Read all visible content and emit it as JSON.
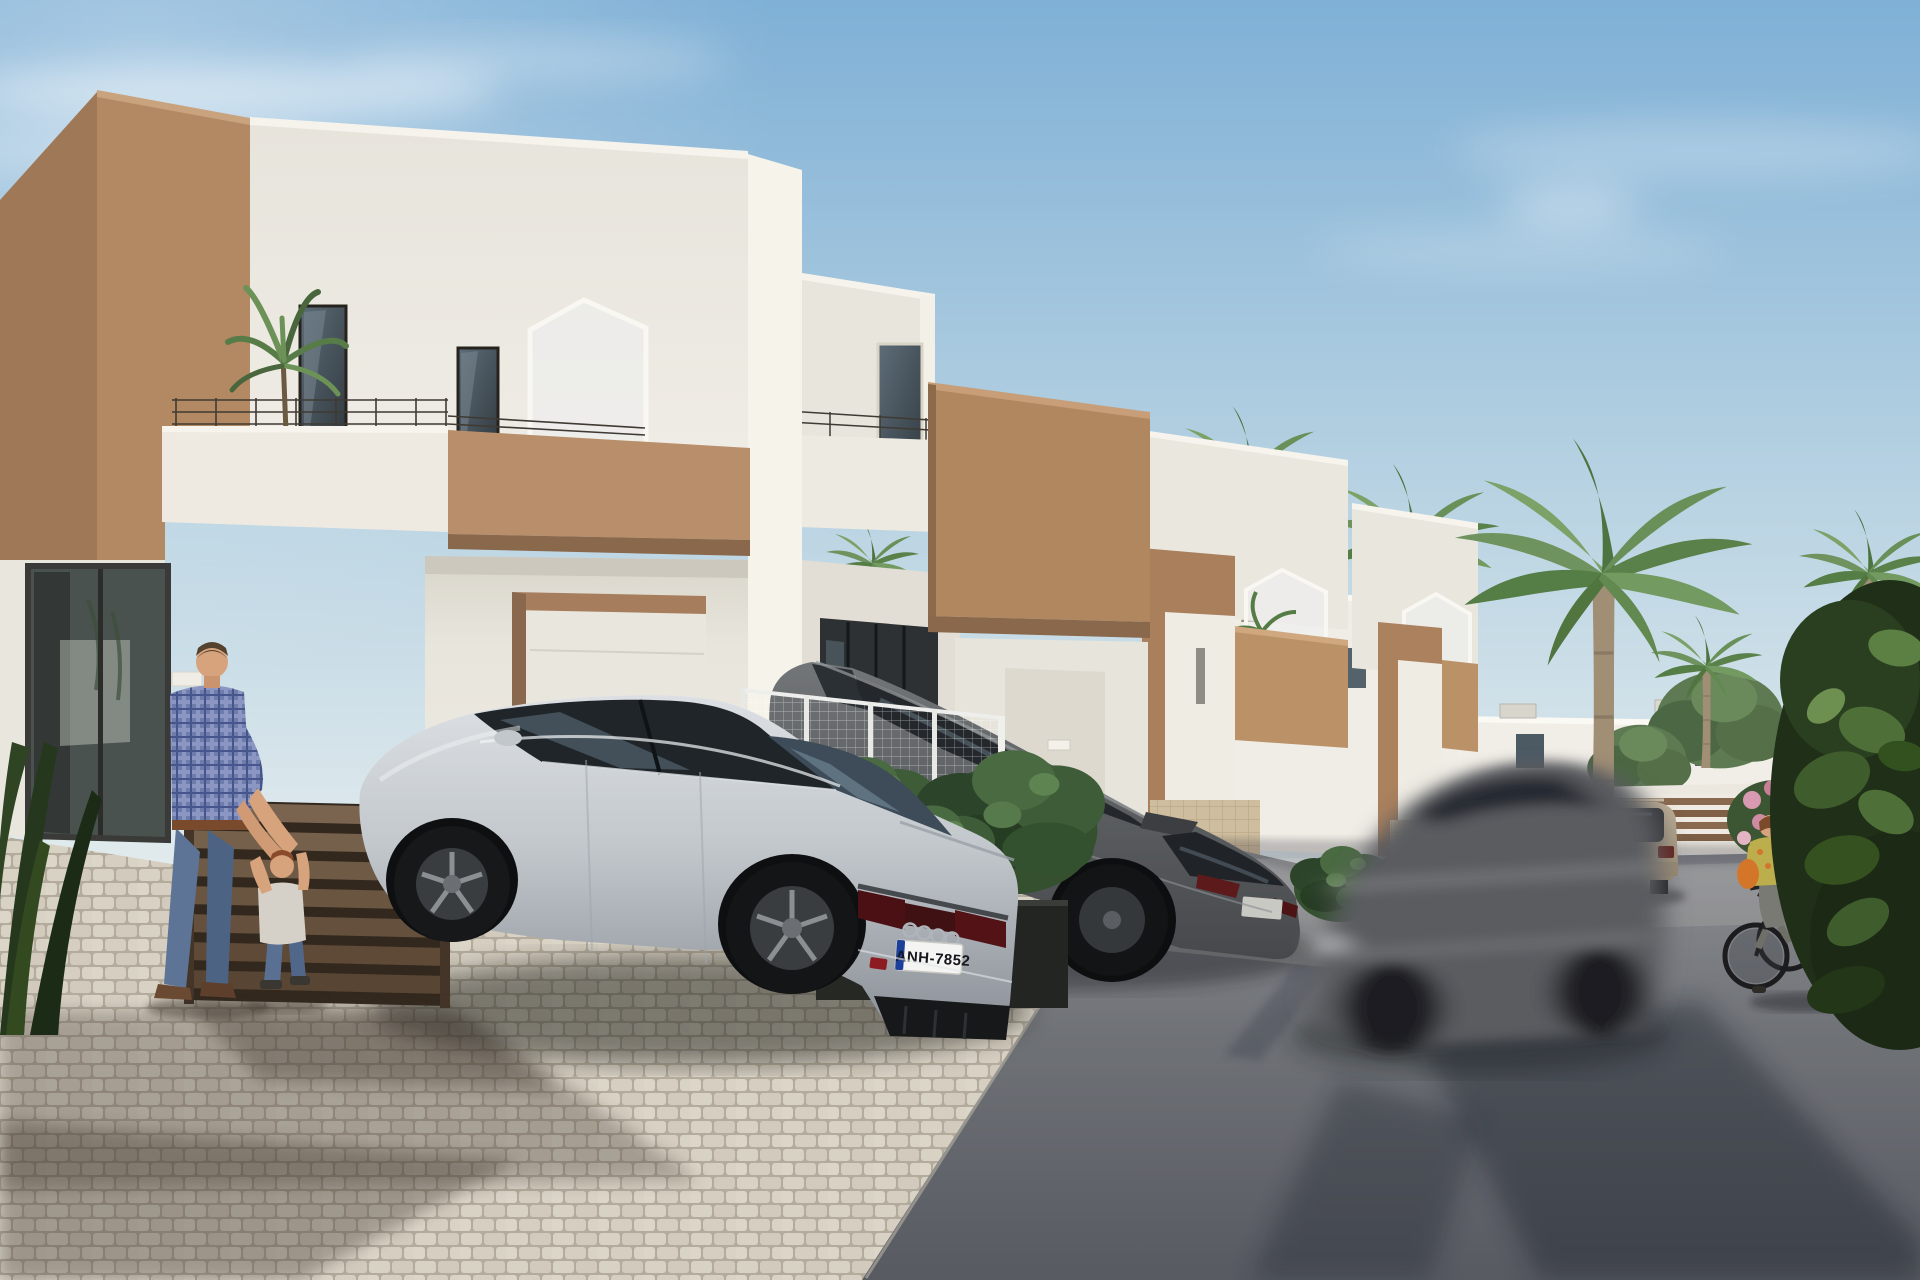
{
  "scene": {
    "type": "3D architectural visualization",
    "title": "New-build townhouse street, sunny day",
    "sky": "clear blue with wispy clouds",
    "lighting": "sun from upper left, shadows cast to lower right"
  },
  "palette": {
    "sky_top": "#7fb0d6",
    "sky_horizon": "#e3ecee",
    "wall_white": "#ece9e1",
    "accent_tan": "#b28a66",
    "paving_cobble": "#d5cec1",
    "asphalt": "#6f7277",
    "foliage_green": "#4e6f41",
    "car_silver": "#c6cbd0",
    "car_graphite": "#5b5e61",
    "car_beige": "#a8977e",
    "plaid_shirt_blue": "#6d7cab",
    "cyclist_top_yellow": "#bcae4c",
    "plate_band_blue": "#1d3f9c",
    "plaque_gold": "#b5922f"
  },
  "buildings": {
    "foreground_houses_count": 4,
    "style": "modern two-storey white townhouses with tan accent volumes",
    "features": [
      "roof terraces with thin dark railings",
      "pentagon frosted-glass privacy screens",
      "tan entrance portals with white reveals",
      "gold house-number plaques",
      "ground-floor glass sliders",
      "brown horizontal-slat fences"
    ],
    "background": "white flat-roof villas with small dark windows and rooftop units"
  },
  "vehicles": {
    "audi": {
      "type": "silver sedan, rear three-quarter view",
      "license_plate": "ANH-7852",
      "brand_badge": "four rings",
      "details": "dark tail-light bar, black diffuser, red RS badge"
    },
    "gray_suv": {
      "type": "graphite SUV",
      "state": "parked behind white mesh fence"
    },
    "moving_car": {
      "type": "dark gray hatchback",
      "state": "motion-blurred, driving past"
    },
    "beige_suv": {
      "type": "champagne beige SUV",
      "state": "parked down the street, rear view"
    }
  },
  "people": {
    "father": {
      "clothing": "blue plaid shirt, jeans, brown shoes",
      "action": "holding toddler's hands"
    },
    "child": {
      "clothing": "light t-shirt, jeans",
      "hair": "auburn"
    },
    "cyclist": {
      "clothing": "yellow patterned top, gray trousers",
      "accessory": "orange shoulder bag",
      "action": "riding toward viewer"
    }
  },
  "vegetation": {
    "palm_trees": 6,
    "balcony_plant": "small palm on house 1 terrace",
    "planter_shrubs": 3,
    "right_foreground_bush": "large dark green shrub",
    "pink_flower_bush": "beside cyclist",
    "left_foreground_plant": "dark strap-leaf plant"
  },
  "ground": {
    "foreground": "beige cobblestone paver driveway",
    "road": "asphalt street with long tree shadows"
  }
}
